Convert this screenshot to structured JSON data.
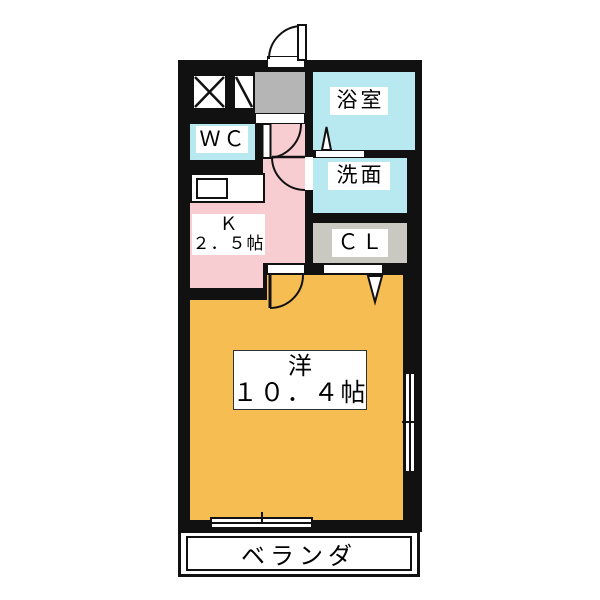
{
  "floorplan": {
    "type": "apartment-floor-plan",
    "rooms": {
      "bath": {
        "label": "浴室",
        "color": "#b8e9f1"
      },
      "washroom": {
        "label": "洗面",
        "color": "#b8e9f1"
      },
      "wc": {
        "label": "ＷＣ",
        "color": "#b8e9f1"
      },
      "closet": {
        "label": "ＣＬ",
        "color": "#c9c9c1"
      },
      "kitchen": {
        "label": "Ｋ",
        "size_label": "２．５帖",
        "color": "#f8cdd2"
      },
      "living": {
        "label": "洋",
        "size_label": "１０．４帖",
        "color": "#f6bd52"
      },
      "veranda": {
        "label": "ベランダ",
        "color": "#ffffff"
      },
      "entrance": {
        "color": "#b5b5b5"
      }
    },
    "wall_color": "#111111",
    "background_color": "#ffffff",
    "symbols": [
      "entrance-door-swing-icon",
      "hall-door-swing-icon",
      "washroom-door-swing-icon",
      "living-door-swing-icon",
      "bath-folding-door-icon",
      "closet-folding-door-icon",
      "shaft-cross-icon",
      "shaft-diagonal-icon",
      "sliding-window-icon",
      "sliding-window-icon"
    ]
  }
}
